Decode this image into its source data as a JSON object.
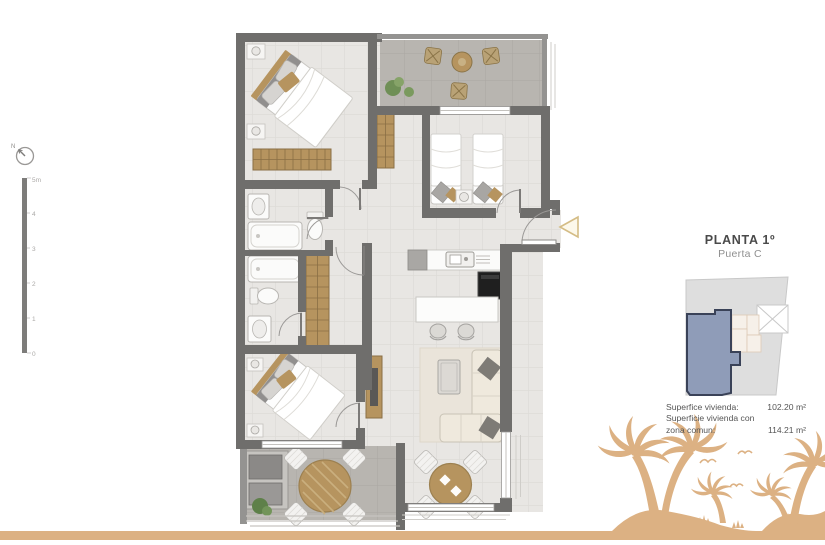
{
  "info_panel": {
    "title": "PLANTA 1º",
    "subtitle": "Puerta C",
    "areas": [
      {
        "label": "Superfice vivienda:",
        "value": "102.20 m²"
      },
      {
        "label": "Superficie vivienda con",
        "value": ""
      },
      {
        "label": "zona comun:",
        "value": "114.21 m²"
      }
    ]
  },
  "compass": {
    "label": "N"
  },
  "scale_bar": {
    "labels": [
      "5m",
      "4",
      "3",
      "2",
      "1",
      "0"
    ]
  },
  "colors": {
    "wall": "#6f6e6c",
    "wall-light": "#949391",
    "floor": "#e8e6e3",
    "floor-line": "#dcdad6",
    "terrace": "#b8b5b0",
    "terrace-line": "#aaa7a2",
    "wood": "#b6945f",
    "wood-dark": "#8a6f45",
    "accent": "#dcb183",
    "unit-highlight": "#8f9cb8",
    "unit-border": "#3a4258",
    "keyplan-bg": "#dedede"
  }
}
